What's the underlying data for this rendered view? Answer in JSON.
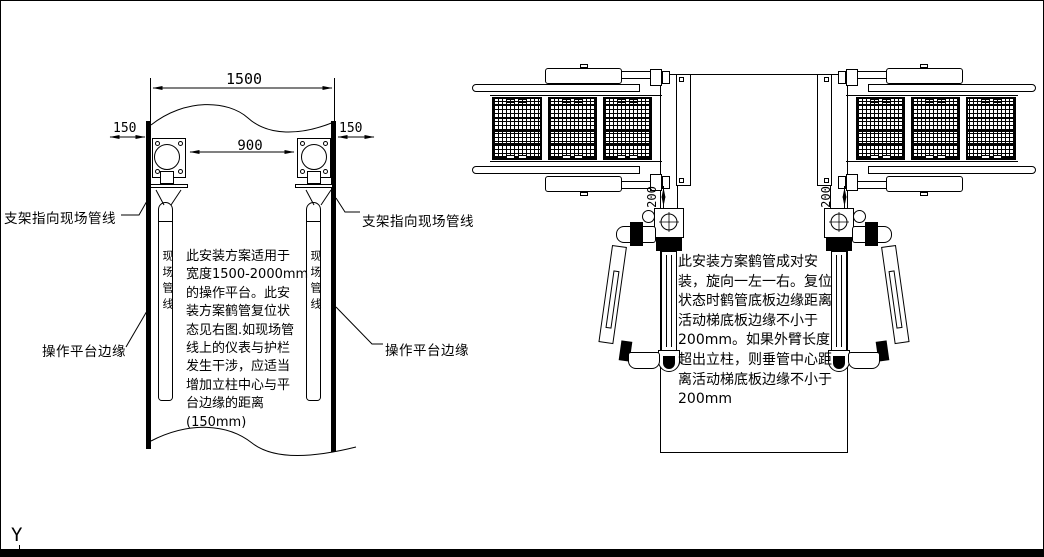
{
  "colors": {
    "ink": "#000000",
    "paper": "#ffffff"
  },
  "axis_label": "Y",
  "left_view": {
    "dim_total": "1500",
    "dim_left": "150",
    "dim_right": "150",
    "dim_inner": "900",
    "label_bracket_left": "支架指向现场管线",
    "label_bracket_right": "支架指向现场管线",
    "label_edge_left": "操作平台边缘",
    "label_edge_right": "操作平台边缘",
    "pipe_label_left": "现场管线",
    "pipe_label_right": "现场管线",
    "note_lines": [
      "此安装方案适用于",
      "宽度1500-2000mm",
      "的操作平台。此安",
      "装方案鹤管复位状",
      "态见右图.如现场管",
      "线上的仪表与护栏",
      "发生干涉，应适当",
      "增加立柱中心与平",
      "台边缘的距离",
      "(150mm)"
    ]
  },
  "right_view": {
    "dim_gap_left": "200",
    "dim_gap_right": "200",
    "note_lines": [
      "此安装方案鹤管成对安",
      "装，旋向一左一右。复位",
      "状态时鹤管底板边缘距离",
      "活动梯底板边缘不小于",
      "200mm。如果外臂长度",
      "超出立柱，则垂管中心距",
      "离活动梯底板边缘不小于",
      "200mm"
    ]
  }
}
